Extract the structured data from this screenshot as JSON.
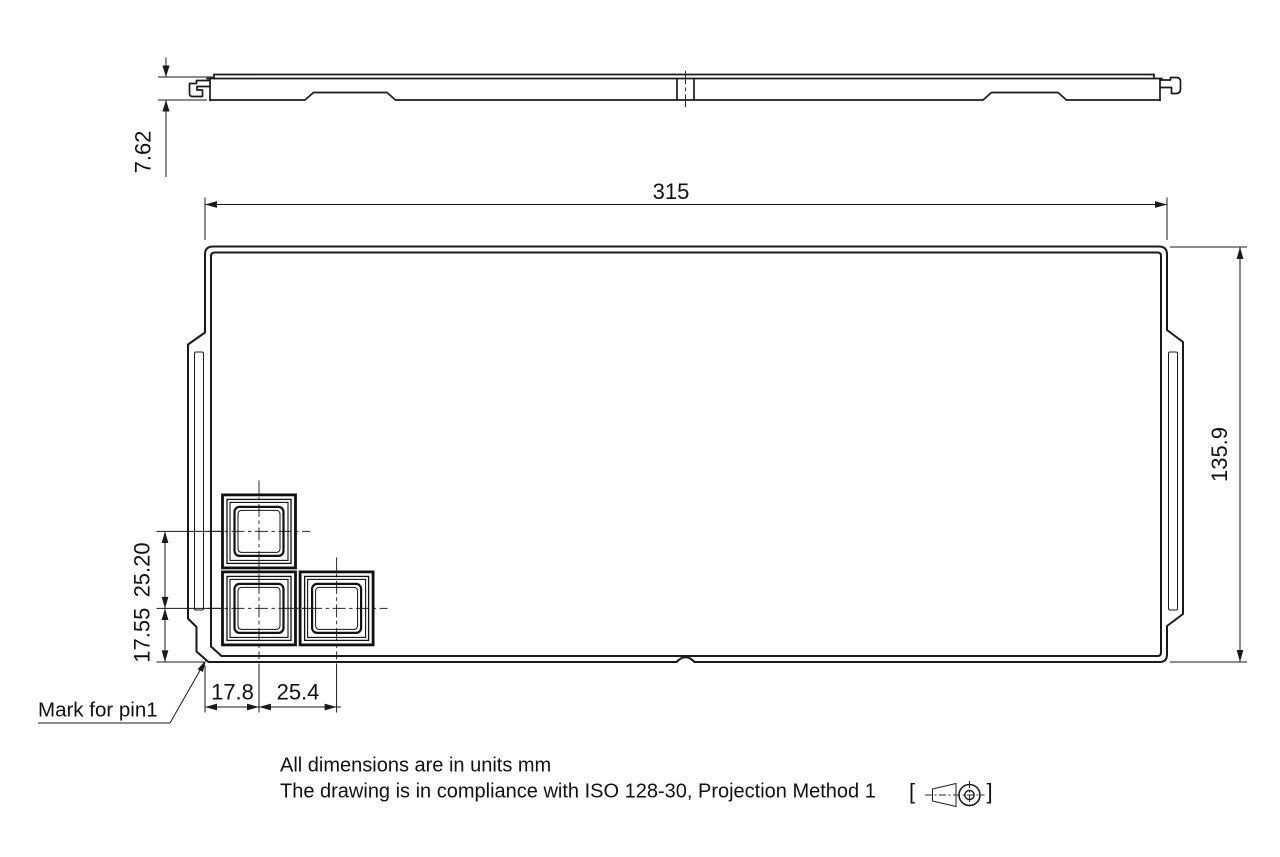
{
  "dims": {
    "thickness": "7.62",
    "width": "315",
    "height": "135.9",
    "pitch_v": "25.20",
    "offset_bottom": "17.55",
    "offset_left": "17.8",
    "pitch_h": "25.4"
  },
  "labels": {
    "pin1": "Mark for pin1"
  },
  "notes": {
    "units": "All dimensions are in units mm",
    "compliance": "The drawing is in compliance with ISO 128-30, Projection Method 1",
    "bracket_open": "[",
    "bracket_close": "]"
  },
  "colors": {
    "line": "#1a1a1a",
    "background": "#ffffff"
  }
}
